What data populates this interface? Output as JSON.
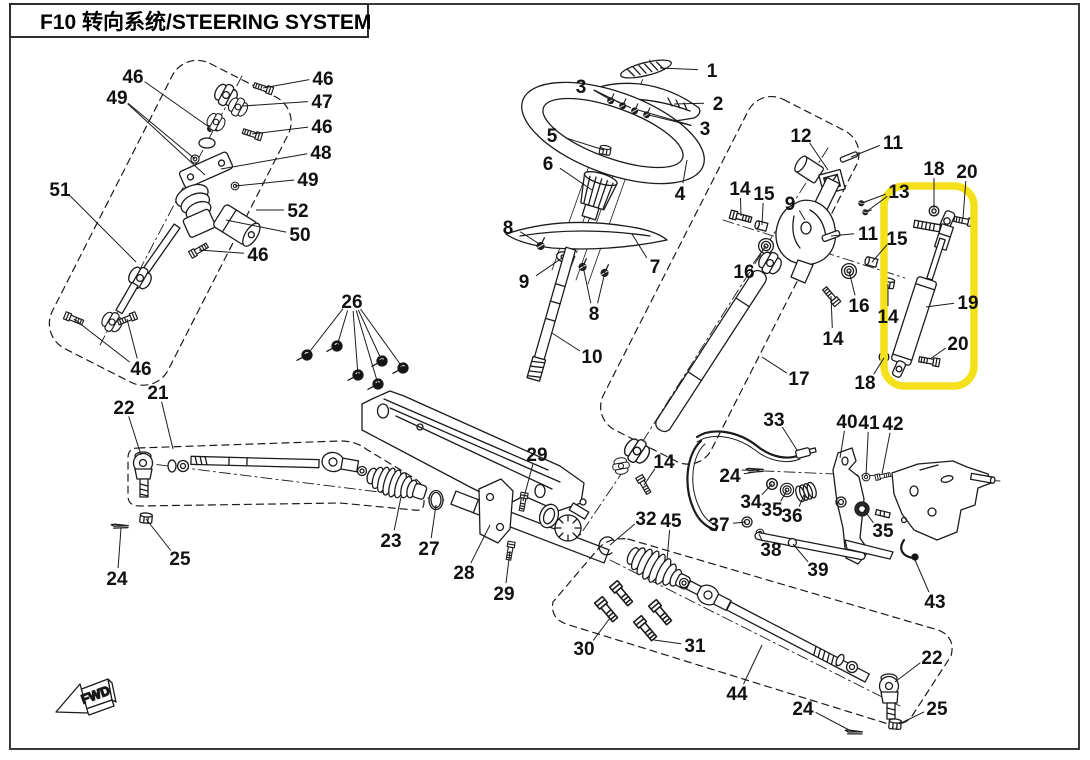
{
  "title": "F10 转向系统/STEERING SYSTEM",
  "fwd_label": "FWD",
  "highlight": {
    "color": "#F4E11C"
  },
  "callouts": [
    {
      "t": "46",
      "x": 133,
      "y": 76,
      "tg": [
        [
          209,
          127
        ]
      ]
    },
    {
      "t": "49",
      "x": 117,
      "y": 97,
      "tg": [
        [
          195,
          159
        ],
        [
          205,
          175
        ]
      ]
    },
    {
      "t": "46",
      "x": 323,
      "y": 78,
      "tg": [
        [
          263,
          88
        ]
      ]
    },
    {
      "t": "47",
      "x": 322,
      "y": 101,
      "tg": [
        [
          243,
          106
        ]
      ]
    },
    {
      "t": "46",
      "x": 322,
      "y": 126,
      "tg": [
        [
          252,
          134
        ]
      ]
    },
    {
      "t": "48",
      "x": 321,
      "y": 152,
      "tg": [
        [
          221,
          169
        ]
      ]
    },
    {
      "t": "49",
      "x": 308,
      "y": 179,
      "tg": [
        [
          235,
          186
        ]
      ]
    },
    {
      "t": "52",
      "x": 298,
      "y": 210,
      "tg": [
        [
          256,
          210
        ]
      ]
    },
    {
      "t": "50",
      "x": 300,
      "y": 234,
      "tg": [
        [
          226,
          220
        ]
      ]
    },
    {
      "t": "46",
      "x": 258,
      "y": 254,
      "tg": [
        [
          199,
          250
        ]
      ]
    },
    {
      "t": "51",
      "x": 60,
      "y": 189,
      "tg": [
        [
          136,
          262
        ]
      ]
    },
    {
      "t": "46",
      "x": 141,
      "y": 368,
      "tg": [
        [
          74,
          319
        ],
        [
          127,
          319
        ]
      ]
    },
    {
      "t": "1",
      "x": 712,
      "y": 70,
      "tg": [
        [
          660,
          68
        ]
      ]
    },
    {
      "t": "2",
      "x": 718,
      "y": 103,
      "tg": [
        [
          674,
          104
        ]
      ]
    },
    {
      "t": "3",
      "x": 581,
      "y": 86,
      "tg": [
        [
          609,
          99
        ],
        [
          620,
          103
        ],
        [
          631,
          108
        ]
      ]
    },
    {
      "t": "3",
      "x": 705,
      "y": 128,
      "tg": [
        [
          638,
          110
        ],
        [
          649,
          115
        ]
      ]
    },
    {
      "t": "4",
      "x": 680,
      "y": 193,
      "tg": [
        [
          687,
          160
        ]
      ]
    },
    {
      "t": "5",
      "x": 552,
      "y": 135,
      "tg": [
        [
          604,
          150
        ]
      ]
    },
    {
      "t": "6",
      "x": 548,
      "y": 163,
      "tg": [
        [
          592,
          190
        ]
      ]
    },
    {
      "t": "7",
      "x": 655,
      "y": 266,
      "tg": [
        [
          632,
          234
        ]
      ]
    },
    {
      "t": "8",
      "x": 508,
      "y": 227,
      "tg": [
        [
          541,
          245
        ]
      ]
    },
    {
      "t": "8",
      "x": 594,
      "y": 313,
      "tg": [
        [
          583,
          266
        ],
        [
          605,
          272
        ]
      ]
    },
    {
      "t": "9",
      "x": 524,
      "y": 281,
      "tg": [
        [
          562,
          258
        ]
      ]
    },
    {
      "t": "10",
      "x": 592,
      "y": 356,
      "tg": [
        [
          552,
          333
        ]
      ]
    },
    {
      "t": "12",
      "x": 801,
      "y": 135,
      "tg": [
        [
          828,
          170
        ]
      ]
    },
    {
      "t": "11",
      "x": 893,
      "y": 142,
      "tg": [
        [
          851,
          157
        ]
      ]
    },
    {
      "t": "13",
      "x": 899,
      "y": 191,
      "tg": [
        [
          862,
          203
        ],
        [
          866,
          212
        ]
      ]
    },
    {
      "t": "9",
      "x": 790,
      "y": 203,
      "tg": [
        [
          805,
          220
        ]
      ]
    },
    {
      "t": "11",
      "x": 868,
      "y": 233,
      "tg": [
        [
          831,
          236
        ]
      ]
    },
    {
      "t": "14",
      "x": 740,
      "y": 188,
      "tg": [
        [
          741,
          216
        ]
      ]
    },
    {
      "t": "15",
      "x": 764,
      "y": 193,
      "tg": [
        [
          762,
          225
        ]
      ]
    },
    {
      "t": "16",
      "x": 744,
      "y": 271,
      "tg": [
        [
          766,
          246
        ]
      ]
    },
    {
      "t": "16",
      "x": 859,
      "y": 305,
      "tg": [
        [
          849,
          271
        ]
      ]
    },
    {
      "t": "14",
      "x": 833,
      "y": 338,
      "tg": [
        [
          831,
          296
        ]
      ]
    },
    {
      "t": "17",
      "x": 799,
      "y": 378,
      "tg": [
        [
          762,
          357
        ]
      ]
    },
    {
      "t": "15",
      "x": 897,
      "y": 238,
      "tg": [
        [
          872,
          262
        ]
      ]
    },
    {
      "t": "14",
      "x": 888,
      "y": 316,
      "tg": [
        [
          888,
          284
        ]
      ]
    },
    {
      "t": "18",
      "x": 934,
      "y": 168,
      "tg": [
        [
          934,
          208
        ]
      ]
    },
    {
      "t": "20",
      "x": 967,
      "y": 171,
      "tg": [
        [
          963,
          218
        ]
      ]
    },
    {
      "t": "19",
      "x": 968,
      "y": 302,
      "tg": [
        [
          926,
          307
        ]
      ]
    },
    {
      "t": "20",
      "x": 958,
      "y": 343,
      "tg": [
        [
          930,
          359
        ]
      ]
    },
    {
      "t": "18",
      "x": 865,
      "y": 382,
      "tg": [
        [
          884,
          358
        ]
      ]
    },
    {
      "t": "26",
      "x": 352,
      "y": 301,
      "tg": [
        [
          307,
          355
        ],
        [
          337,
          346
        ],
        [
          358,
          375
        ],
        [
          378,
          384
        ],
        [
          382,
          361
        ],
        [
          403,
          368
        ]
      ]
    },
    {
      "t": "21",
      "x": 158,
      "y": 392,
      "tg": [
        [
          173,
          449
        ]
      ]
    },
    {
      "t": "22",
      "x": 124,
      "y": 407,
      "tg": [
        [
          141,
          455
        ]
      ]
    },
    {
      "t": "23",
      "x": 391,
      "y": 540,
      "tg": [
        [
          401,
          497
        ]
      ]
    },
    {
      "t": "27",
      "x": 429,
      "y": 548,
      "tg": [
        [
          436,
          505
        ]
      ]
    },
    {
      "t": "25",
      "x": 180,
      "y": 558,
      "tg": [
        [
          146,
          519
        ]
      ]
    },
    {
      "t": "24",
      "x": 117,
      "y": 578,
      "tg": [
        [
          121,
          528
        ]
      ]
    },
    {
      "t": "28",
      "x": 464,
      "y": 572,
      "tg": [
        [
          490,
          525
        ]
      ]
    },
    {
      "t": "29",
      "x": 537,
      "y": 454,
      "tg": [
        [
          523,
          501
        ]
      ]
    },
    {
      "t": "29",
      "x": 504,
      "y": 593,
      "tg": [
        [
          510,
          551
        ]
      ]
    },
    {
      "t": "14",
      "x": 664,
      "y": 461,
      "tg": [
        [
          644,
          485
        ]
      ]
    },
    {
      "t": "32",
      "x": 646,
      "y": 518,
      "tg": [
        [
          610,
          545
        ]
      ]
    },
    {
      "t": "45",
      "x": 671,
      "y": 520,
      "tg": [
        [
          667,
          560
        ]
      ]
    },
    {
      "t": "30",
      "x": 584,
      "y": 648,
      "tg": [
        [
          610,
          618
        ]
      ]
    },
    {
      "t": "31",
      "x": 695,
      "y": 645,
      "tg": [
        [
          654,
          640
        ]
      ]
    },
    {
      "t": "44",
      "x": 737,
      "y": 693,
      "tg": [
        [
          762,
          645
        ]
      ]
    },
    {
      "t": "24",
      "x": 803,
      "y": 708,
      "tg": [
        [
          851,
          731
        ]
      ]
    },
    {
      "t": "22",
      "x": 932,
      "y": 657,
      "tg": [
        [
          895,
          682
        ]
      ]
    },
    {
      "t": "25",
      "x": 937,
      "y": 708,
      "tg": [
        [
          899,
          724
        ]
      ]
    },
    {
      "t": "33",
      "x": 774,
      "y": 419,
      "tg": [
        [
          797,
          450
        ]
      ]
    },
    {
      "t": "40",
      "x": 847,
      "y": 421,
      "tg": [
        [
          840,
          458
        ]
      ]
    },
    {
      "t": "41",
      "x": 869,
      "y": 422,
      "tg": [
        [
          866,
          476
        ]
      ]
    },
    {
      "t": "42",
      "x": 893,
      "y": 423,
      "tg": [
        [
          882,
          474
        ]
      ]
    },
    {
      "t": "24",
      "x": 730,
      "y": 475,
      "tg": [
        [
          755,
          472
        ]
      ]
    },
    {
      "t": "34",
      "x": 751,
      "y": 501,
      "tg": [
        [
          772,
          484
        ]
      ]
    },
    {
      "t": "35",
      "x": 772,
      "y": 509,
      "tg": [
        [
          787,
          490
        ]
      ]
    },
    {
      "t": "36",
      "x": 792,
      "y": 515,
      "tg": [
        [
          804,
          495
        ]
      ]
    },
    {
      "t": "37",
      "x": 719,
      "y": 524,
      "tg": [
        [
          746,
          522
        ]
      ]
    },
    {
      "t": "38",
      "x": 771,
      "y": 549,
      "tg": [
        [
          759,
          534
        ]
      ]
    },
    {
      "t": "39",
      "x": 818,
      "y": 569,
      "tg": [
        [
          793,
          544
        ]
      ]
    },
    {
      "t": "35",
      "x": 883,
      "y": 530,
      "tg": [
        [
          864,
          510
        ]
      ]
    },
    {
      "t": "43",
      "x": 935,
      "y": 601,
      "tg": [
        [
          915,
          560
        ]
      ]
    }
  ]
}
